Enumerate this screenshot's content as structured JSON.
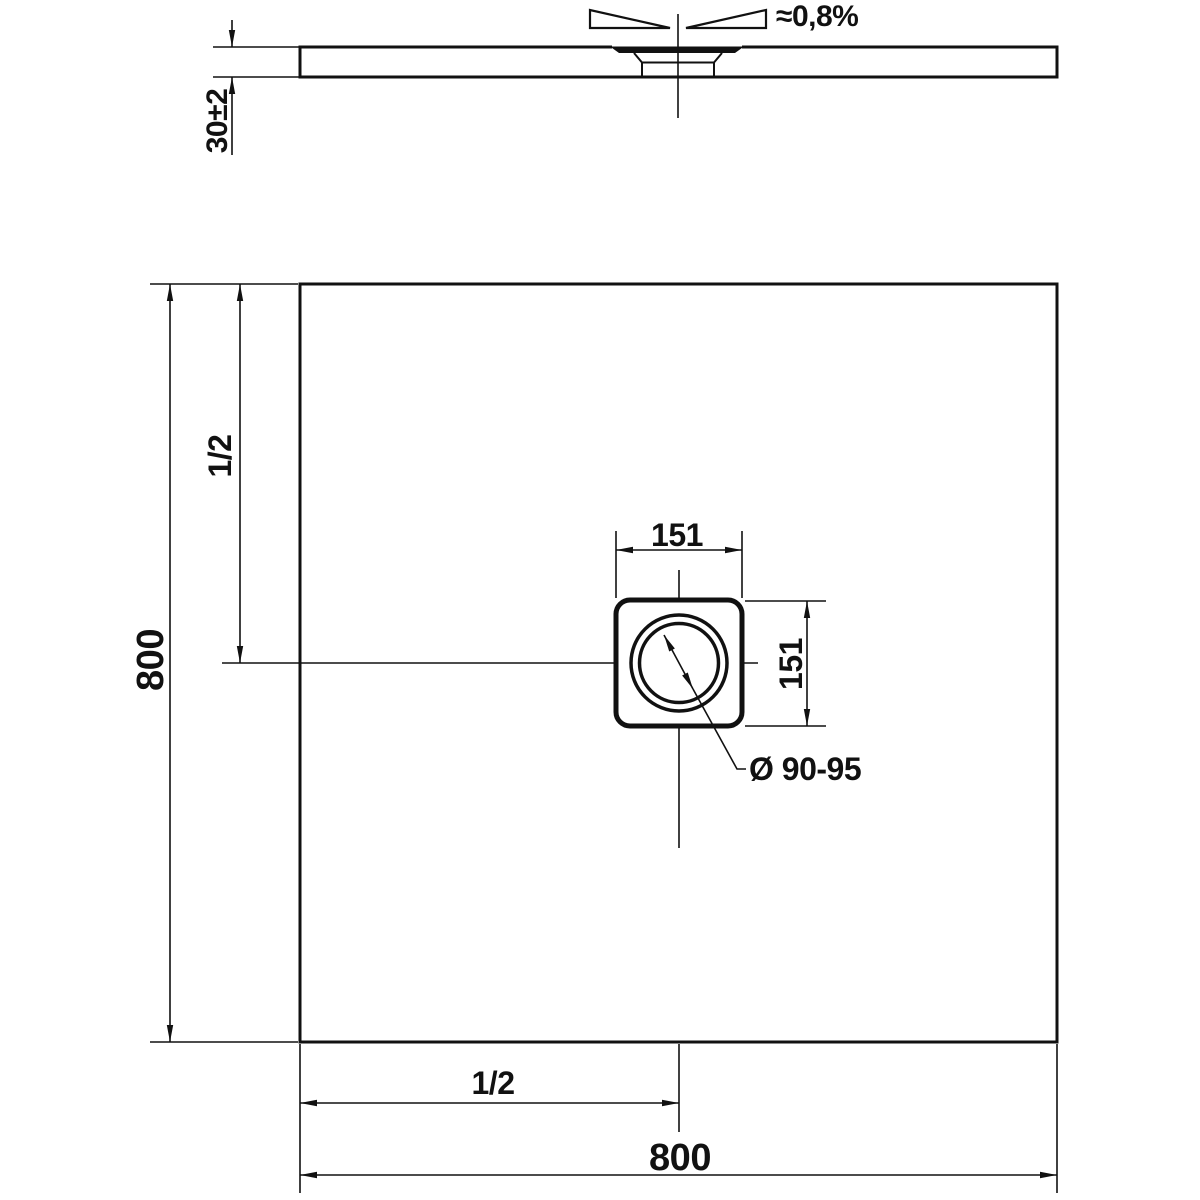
{
  "side_view": {
    "thickness_dim": "30±2",
    "slope_label": "≈0,8%"
  },
  "plan_view": {
    "width_dim": "800",
    "height_dim": "800",
    "half_width_dim": "1/2",
    "half_height_dim": "1/2",
    "drain_width_dim": "151",
    "drain_height_dim": "151",
    "drain_diameter_dim": "Ø 90-95"
  },
  "colors": {
    "line": "#111111",
    "background": "#ffffff"
  }
}
